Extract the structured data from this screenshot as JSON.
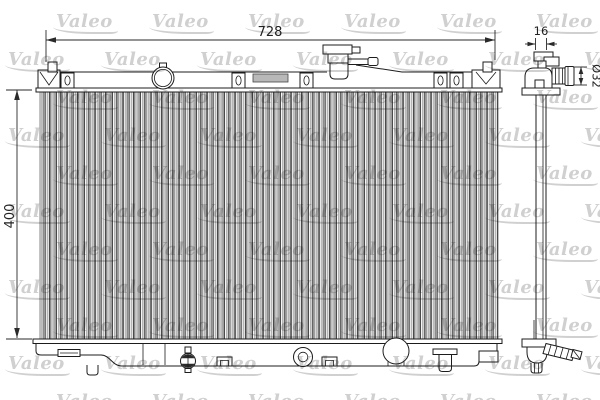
{
  "watermark": {
    "text": "Valeo",
    "color": "#d0d0d0"
  },
  "dimensions": {
    "overall_width": {
      "label": "728"
    },
    "overall_height": {
      "label": "400"
    },
    "core_depth": {
      "label": "16"
    },
    "pipe_diameter": {
      "label": "Ø32"
    }
  },
  "colors": {
    "line": "#1c1c1c",
    "background": "#ffffff",
    "core_stripe_gray": "#b3b3b3"
  }
}
